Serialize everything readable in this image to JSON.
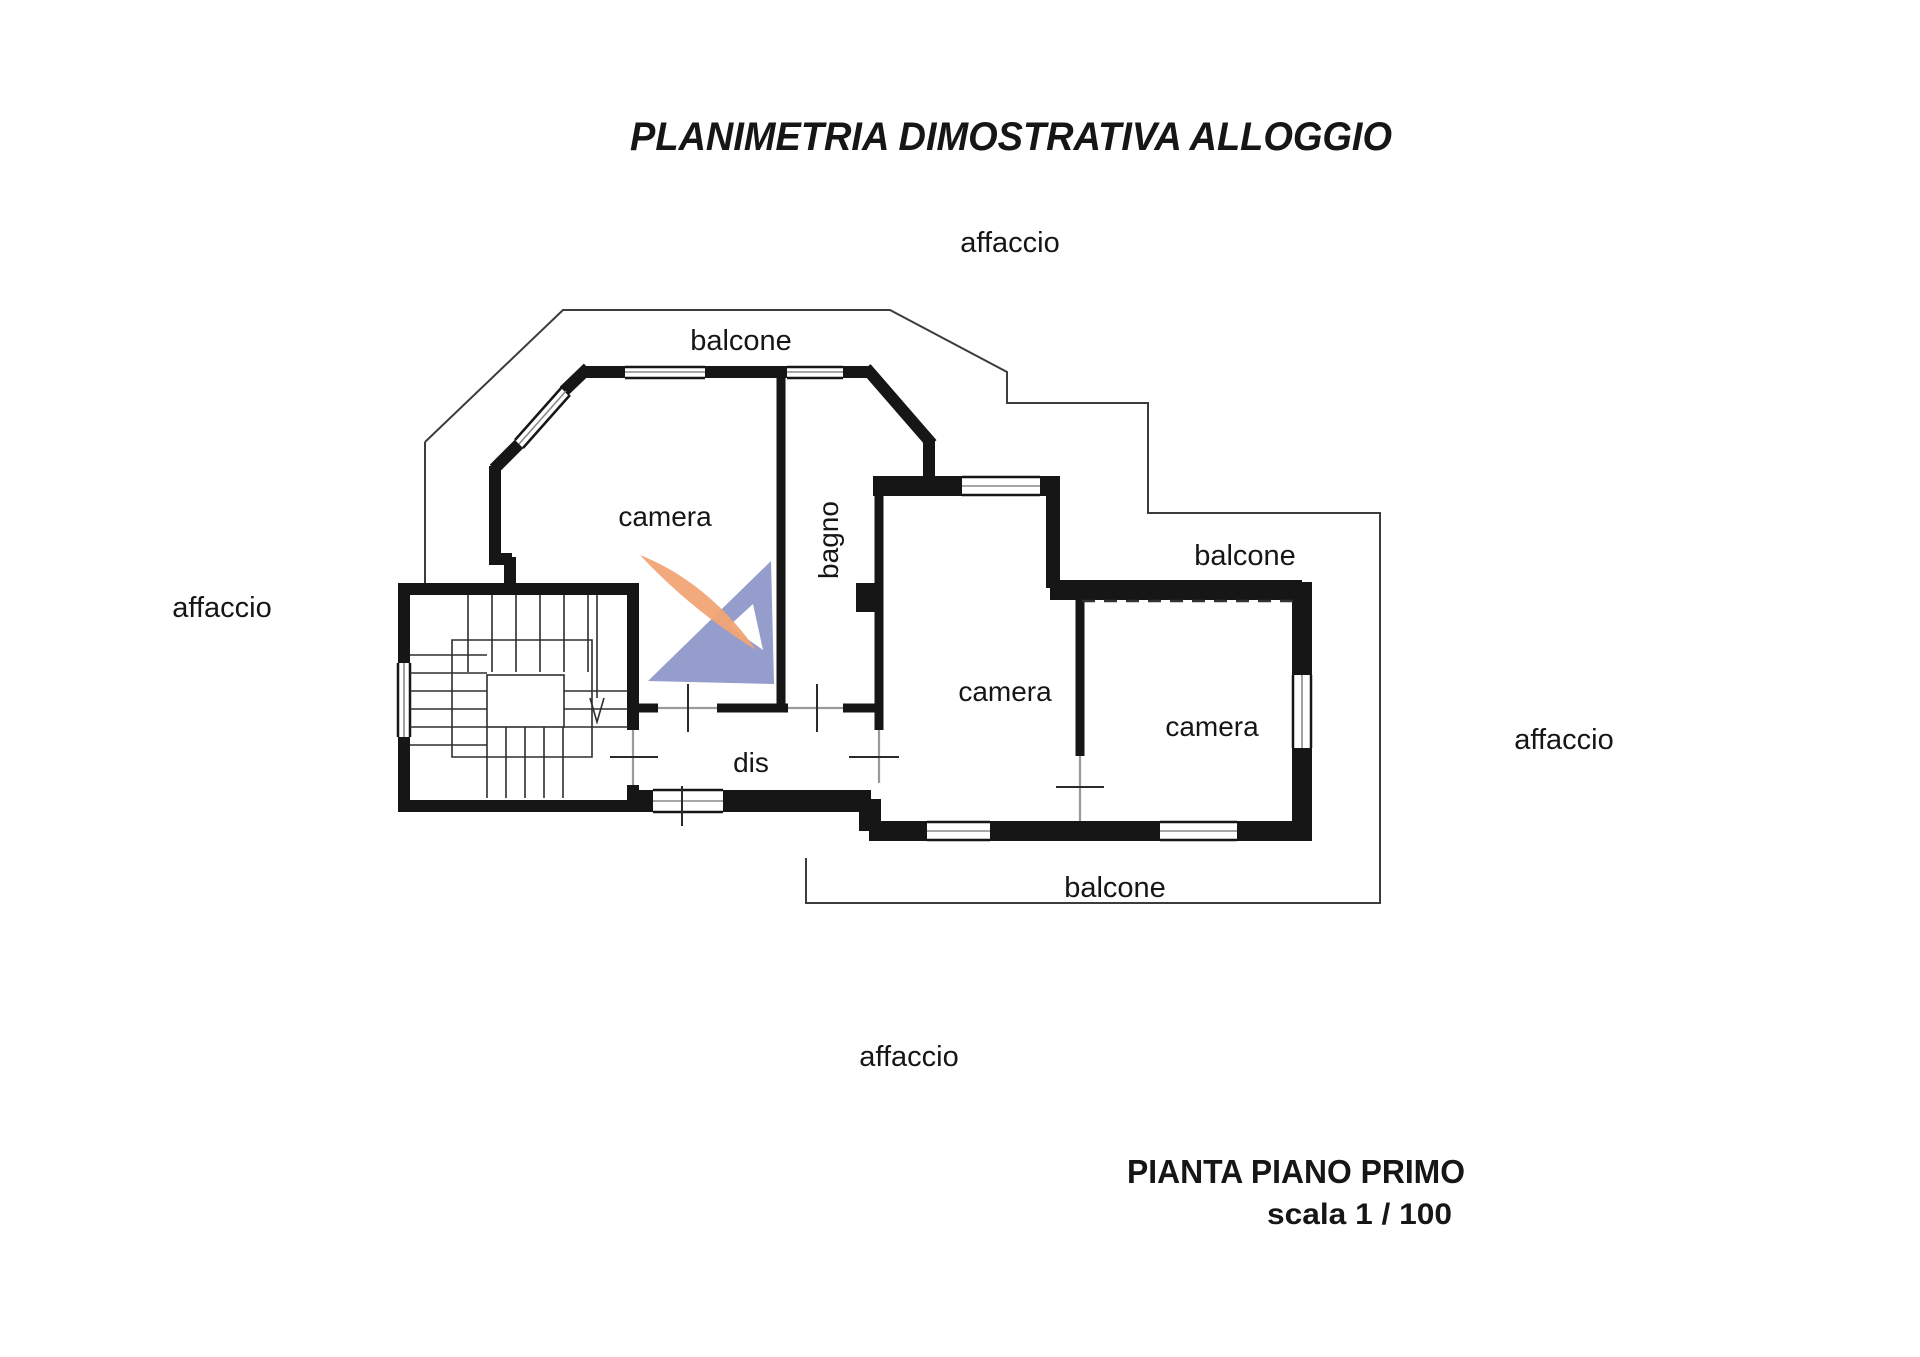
{
  "title": "PLANIMETRIA DIMOSTRATIVA ALLOGGIO",
  "plan": {
    "rooms": [
      {
        "name": "camera",
        "position": "top-left"
      },
      {
        "name": "bagno",
        "position": "center",
        "text_rotation": "-90deg"
      },
      {
        "name": "camera",
        "position": "center-right"
      },
      {
        "name": "camera",
        "position": "right"
      },
      {
        "name": "dis",
        "position": "bottom-center"
      }
    ],
    "balconies": [
      {
        "name": "balcone",
        "position": "top"
      },
      {
        "name": "balcone",
        "position": "right"
      },
      {
        "name": "balcone",
        "position": "bottom"
      }
    ],
    "exposures": [
      {
        "name": "affaccio",
        "position": "top"
      },
      {
        "name": "affaccio",
        "position": "left"
      },
      {
        "name": "affaccio",
        "position": "right"
      },
      {
        "name": "affaccio",
        "position": "bottom"
      }
    ],
    "stairs": {
      "direction": "down"
    }
  },
  "footer": {
    "plan_name": "PIANTA PIANO PRIMO",
    "scale": "scala 1 / 100"
  },
  "watermark": {
    "orange": "#F1A474",
    "blue": "#8B95C8"
  },
  "colors": {
    "wall": "#161616",
    "thin_line": "#3c3c3c",
    "door_line": "#9a9a9a",
    "background": "#FFFFFF"
  }
}
